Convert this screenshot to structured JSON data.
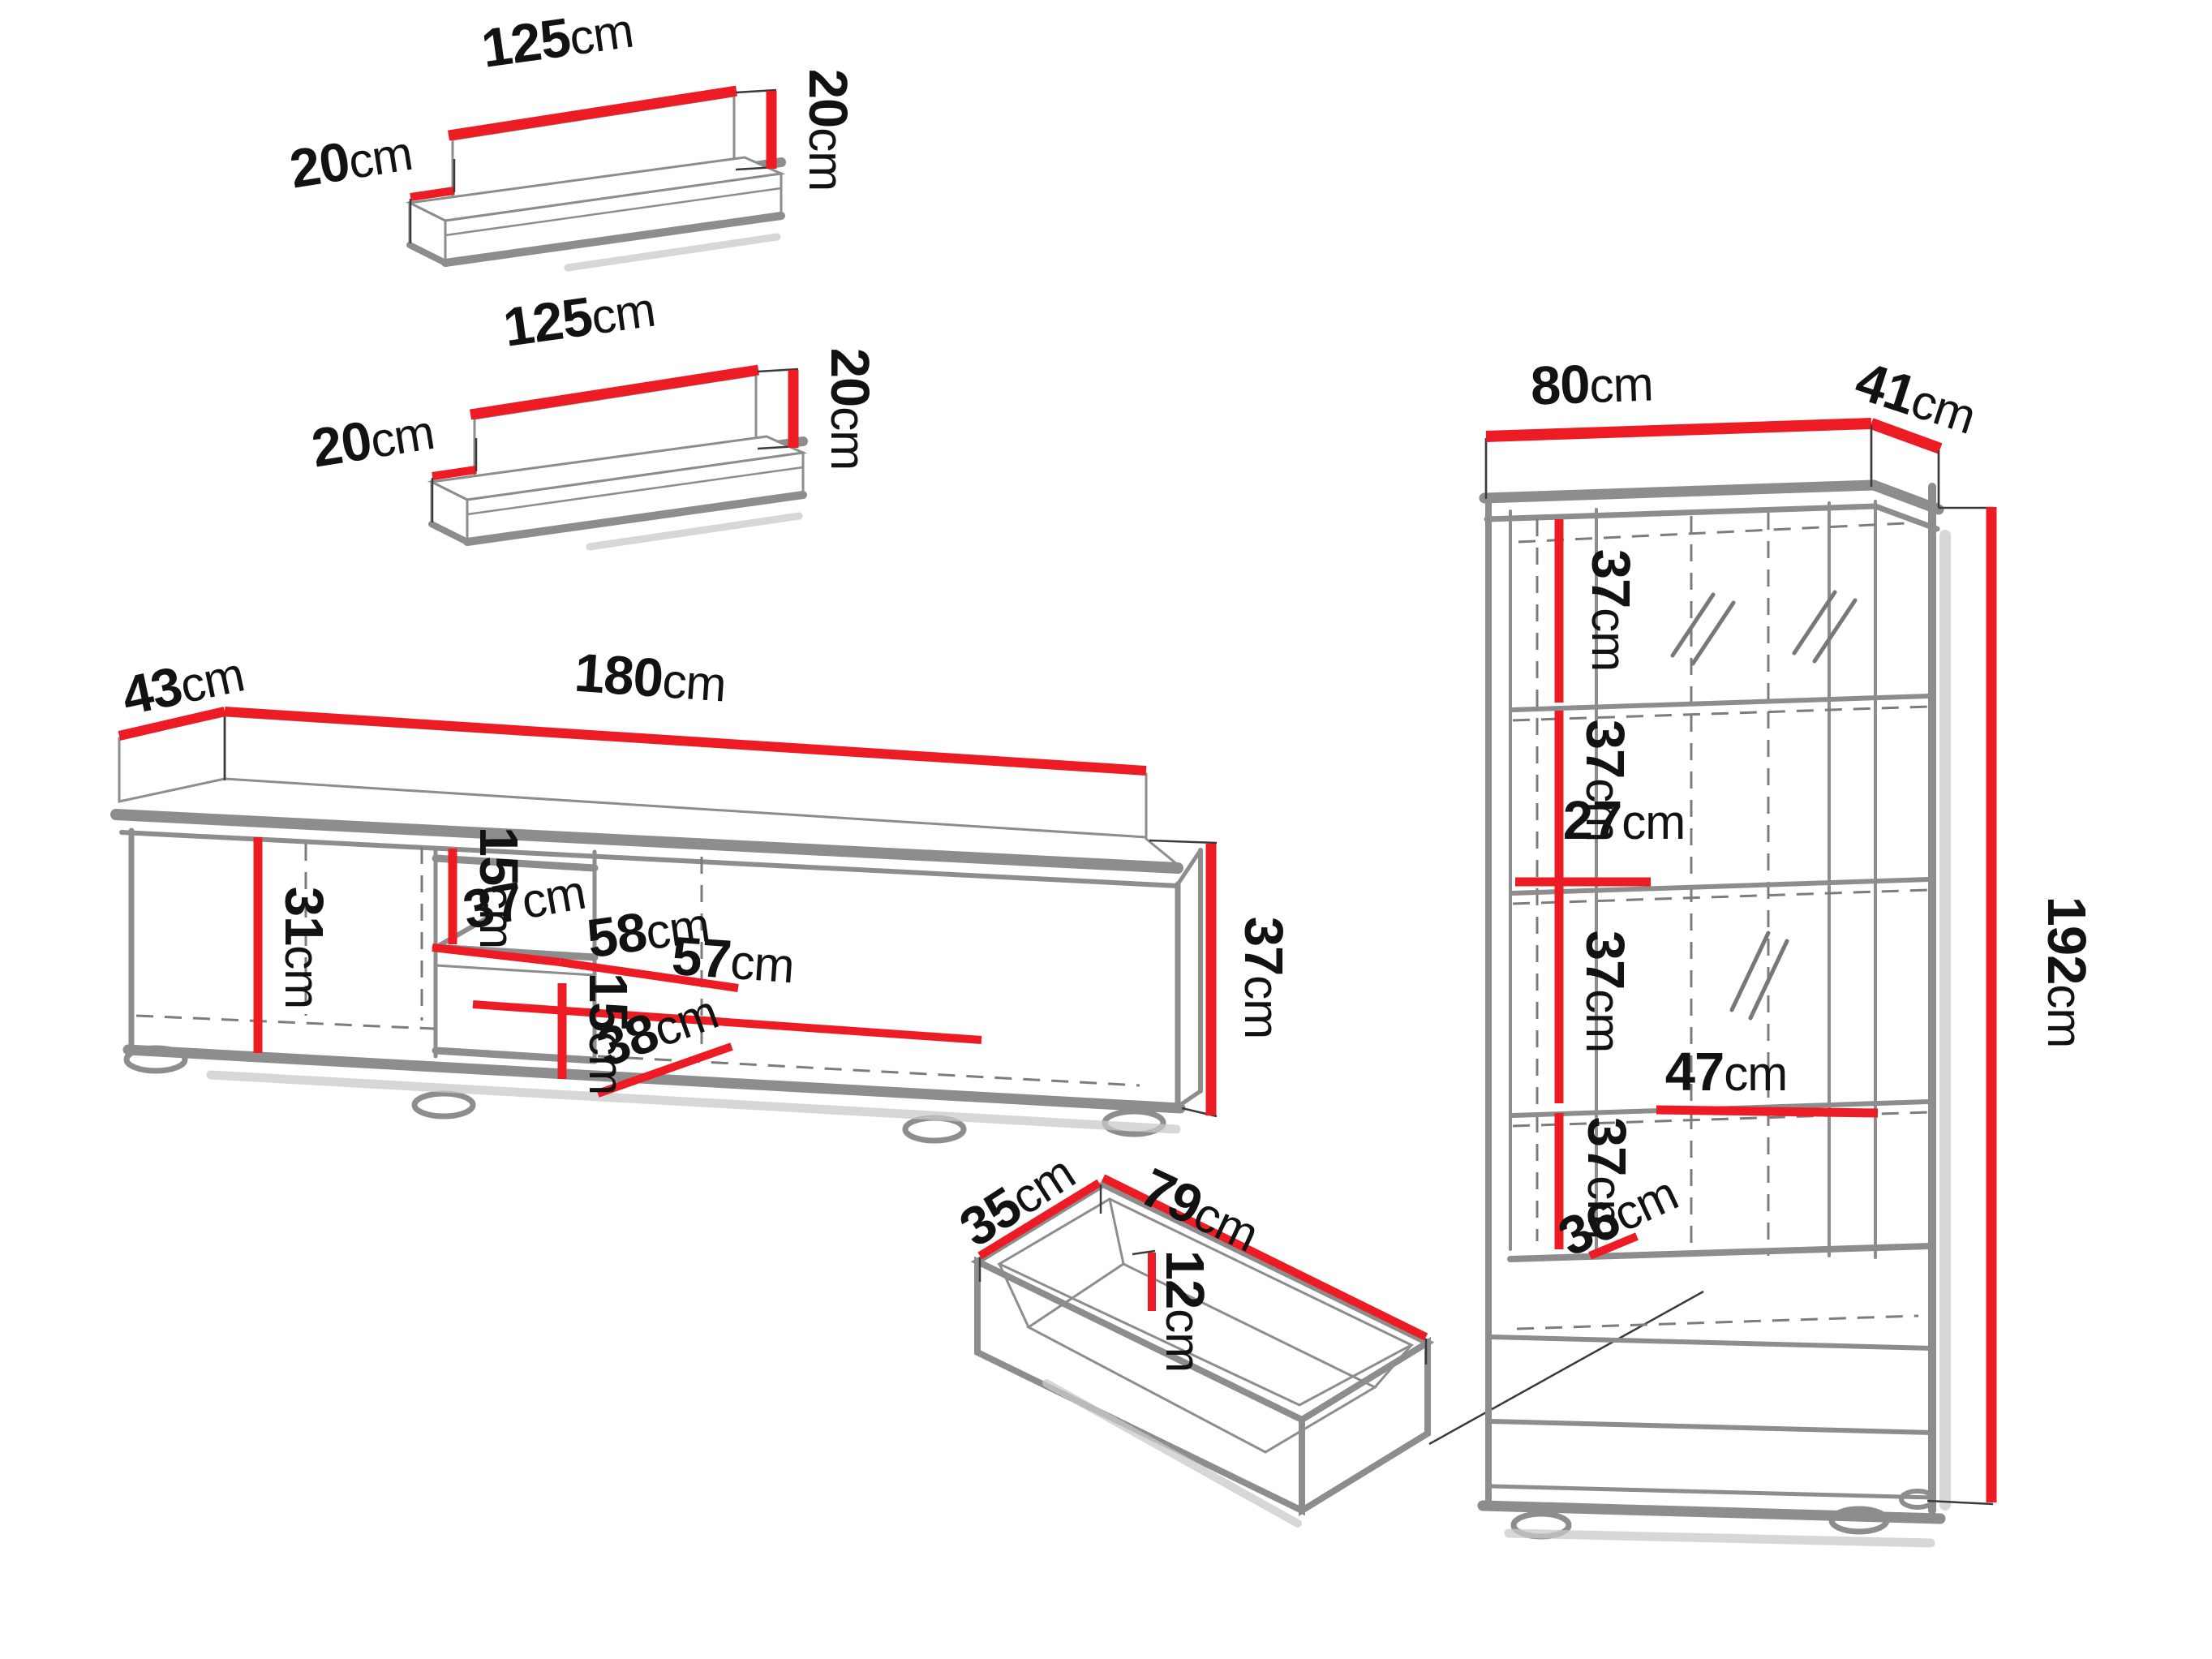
{
  "title": "Furniture wall unit dimensions diagram",
  "unit": "cm",
  "colors": {
    "dimension_line": "#ed1c24",
    "outline_gray": "#8d8d8d",
    "label_text": "#121212",
    "background": "#ffffff"
  },
  "pieces": {
    "shelf_top": {
      "label": "wall shelf (upper)",
      "width": {
        "num": "125",
        "unit": "cm"
      },
      "depth": {
        "num": "20",
        "unit": "cm"
      },
      "height": {
        "num": "20",
        "unit": "cm"
      }
    },
    "shelf_mid": {
      "label": "wall shelf (lower)",
      "width": {
        "num": "125",
        "unit": "cm"
      },
      "depth": {
        "num": "20",
        "unit": "cm"
      },
      "height": {
        "num": "20",
        "unit": "cm"
      }
    },
    "tv_stand": {
      "label": "TV stand",
      "depth": {
        "num": "43",
        "unit": "cm"
      },
      "width": {
        "num": "180",
        "unit": "cm"
      },
      "left_compartment_height": {
        "num": "31",
        "unit": "cm"
      },
      "niche_upper_height": {
        "num": "15",
        "unit": "cm"
      },
      "niche_depth": {
        "num": "37",
        "unit": "cm"
      },
      "niche_width": {
        "num": "58",
        "unit": "cm"
      },
      "right_compartment_width": {
        "num": "57",
        "unit": "cm"
      },
      "niche_lower_height": {
        "num": "15",
        "unit": "cm"
      },
      "right_lower_width": {
        "num": "38",
        "unit": "cm"
      },
      "height": {
        "num": "37",
        "unit": "cm"
      }
    },
    "drawer": {
      "label": "drawer",
      "depth": {
        "num": "35",
        "unit": "cm"
      },
      "width": {
        "num": "79",
        "unit": "cm"
      },
      "height": {
        "num": "12",
        "unit": "cm"
      }
    },
    "cabinet": {
      "label": "display cabinet",
      "width": {
        "num": "80",
        "unit": "cm"
      },
      "depth": {
        "num": "41",
        "unit": "cm"
      },
      "section1_height": {
        "num": "37",
        "unit": "cm"
      },
      "section2_height": {
        "num": "37",
        "unit": "cm"
      },
      "left_column_width": {
        "num": "27",
        "unit": "cm"
      },
      "section3_height": {
        "num": "37",
        "unit": "cm"
      },
      "right_column_width": {
        "num": "47",
        "unit": "cm"
      },
      "section4_height": {
        "num": "37",
        "unit": "cm"
      },
      "bottom_height": {
        "num": "36",
        "unit": "cm"
      },
      "height": {
        "num": "192",
        "unit": "cm"
      }
    }
  }
}
